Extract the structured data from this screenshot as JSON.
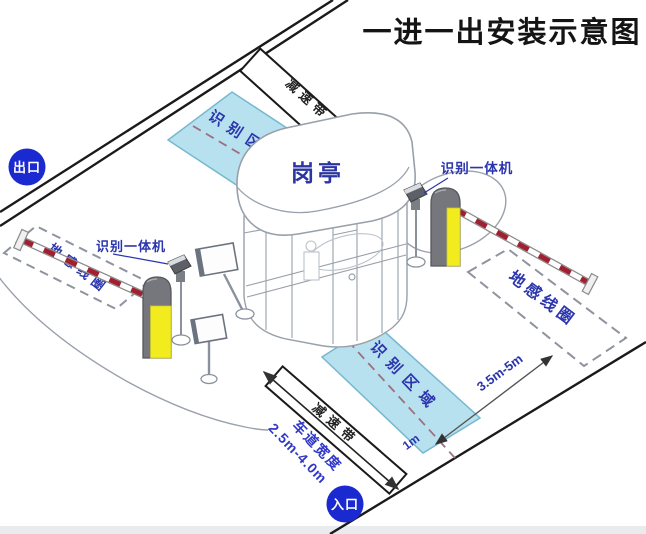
{
  "title": "一进一出安装示意图",
  "badges": {
    "exit": "出口",
    "entrance": "入口"
  },
  "booth": {
    "label": "岗亭"
  },
  "zones": {
    "top_label": "识别区域",
    "bottom_label": "识别区域"
  },
  "loops": {
    "left_label": "地感线圈",
    "right_label": "地感线圈"
  },
  "cameras": {
    "left_label": "识别一体机",
    "right_label": "识别一体机"
  },
  "speed_bumps": {
    "top_label": "减速带",
    "bottom_label": "减速带"
  },
  "dimensions": {
    "loop_to_gate": "3.5m-5m",
    "stop_line_offset": "1m",
    "lane_width_title": "车道宽度",
    "lane_width_value": "2.5m-4.0m"
  },
  "colors": {
    "badge_blue": "#1b2ad0",
    "label_navy": "#2b35ad",
    "lane_text_blue": "#3038c8",
    "zone_fill": "#b5e0ef",
    "zone_border": "#6fb5cd",
    "machine_yellow": "#f2ec1f",
    "machine_gray": "#75777c",
    "arm_stripe_red": "#a02030",
    "loop_dash_gray": "#8e939e",
    "center_dash": "#9b7080",
    "line_black": "#1a1a1a",
    "booth_line": "#98a0aa"
  }
}
